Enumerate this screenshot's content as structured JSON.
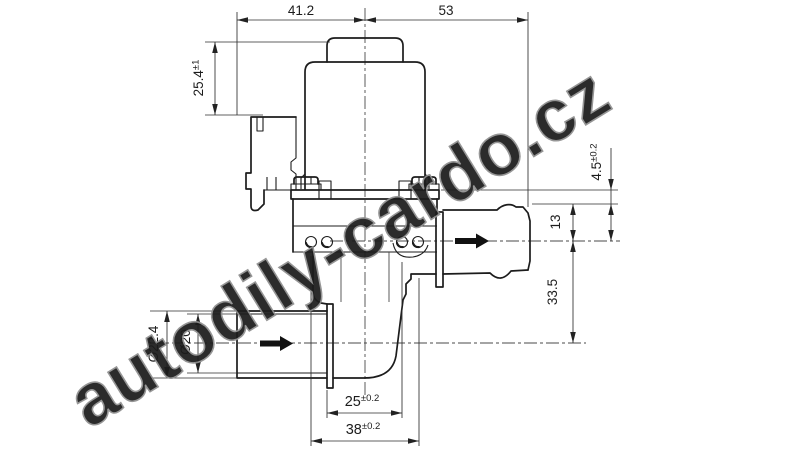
{
  "watermark": {
    "text": "autodily-cardo.cz"
  },
  "dims": {
    "width_left": {
      "value": "41.2",
      "tol": ""
    },
    "width_right": {
      "value": "53",
      "tol": ""
    },
    "cap_height": {
      "value": "25.4",
      "tol": "±1"
    },
    "flange_to_port": {
      "value": "4.5",
      "tol": "±0.2"
    },
    "port_to_axis": {
      "value": "13",
      "tol": ""
    },
    "axis_to_axis": {
      "value": "33.5",
      "tol": ""
    },
    "inlet_od": {
      "value": "Ø22.4",
      "tol": ""
    },
    "inlet_id": {
      "value": "Ø20",
      "tol": ""
    },
    "screw_inner": {
      "value": "25",
      "tol": "±0.2"
    },
    "screw_outer": {
      "value": "38",
      "tol": "±0.2"
    }
  },
  "icons": {
    "flow_inlet": "right-arrow",
    "flow_outlet": "right-arrow"
  },
  "colors": {
    "line": "#1c1c1c",
    "dim": "#2e2e2e",
    "watermark_fill": "#cacaca",
    "watermark_stroke": "#8f8f8f",
    "background": "#ffffff"
  }
}
